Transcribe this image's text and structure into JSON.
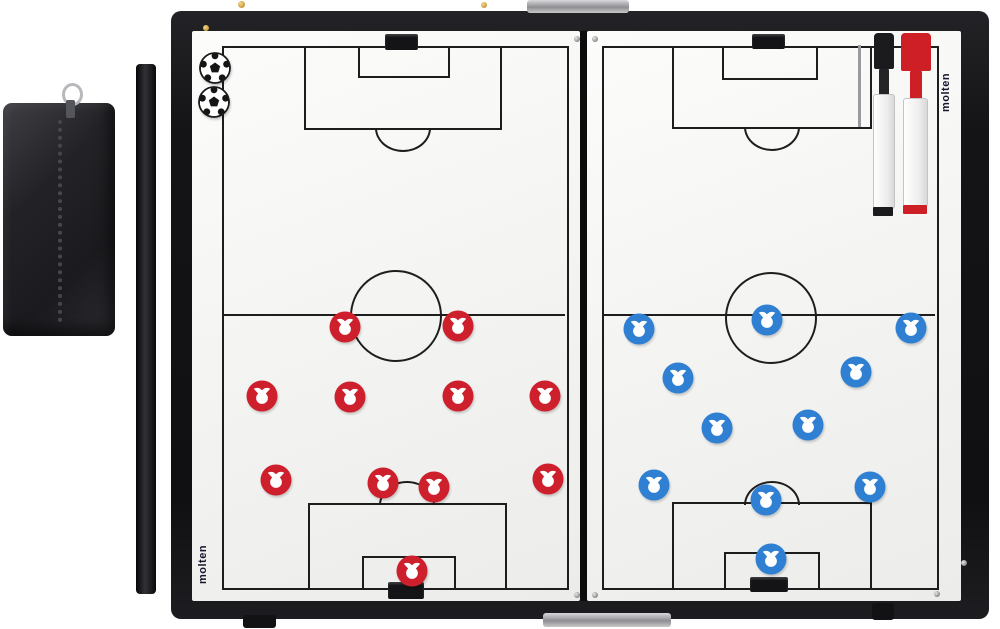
{
  "brand": {
    "name": "molten",
    "logo_color": "#15152b"
  },
  "board": {
    "type": "folding magnetic soccer tactics board",
    "frame_color": "#141416",
    "surface_color": "#f4f4f2",
    "line_color": "#1d1d1d",
    "halves": [
      "left full pitch",
      "right full pitch"
    ]
  },
  "team_red": {
    "color": "#ce1f2d",
    "count": 11,
    "positions": [
      [
        345,
        327
      ],
      [
        458,
        326
      ],
      [
        262,
        396
      ],
      [
        350,
        397
      ],
      [
        458,
        396
      ],
      [
        545,
        396
      ],
      [
        276,
        480
      ],
      [
        383,
        483
      ],
      [
        434,
        487
      ],
      [
        548,
        479
      ],
      [
        412,
        571
      ]
    ]
  },
  "team_blue": {
    "color": "#2f80d2",
    "count": 11,
    "positions": [
      [
        639,
        329
      ],
      [
        767,
        320
      ],
      [
        911,
        328
      ],
      [
        678,
        378
      ],
      [
        856,
        372
      ],
      [
        717,
        428
      ],
      [
        808,
        425
      ],
      [
        654,
        485
      ],
      [
        766,
        500
      ],
      [
        870,
        487
      ],
      [
        771,
        559
      ]
    ]
  },
  "accessories": {
    "balls": {
      "count": 2,
      "positions": [
        [
          215,
          68
        ],
        [
          214,
          102
        ]
      ]
    },
    "pens": [
      {
        "name": "marker-black",
        "accent": "#1b1b1e"
      },
      {
        "name": "marker-red",
        "accent": "#cf1f26"
      }
    ],
    "pen_case": {
      "color": "#232327",
      "zipper": "silver"
    },
    "magnet_bar": {
      "color": "#17171b"
    }
  }
}
